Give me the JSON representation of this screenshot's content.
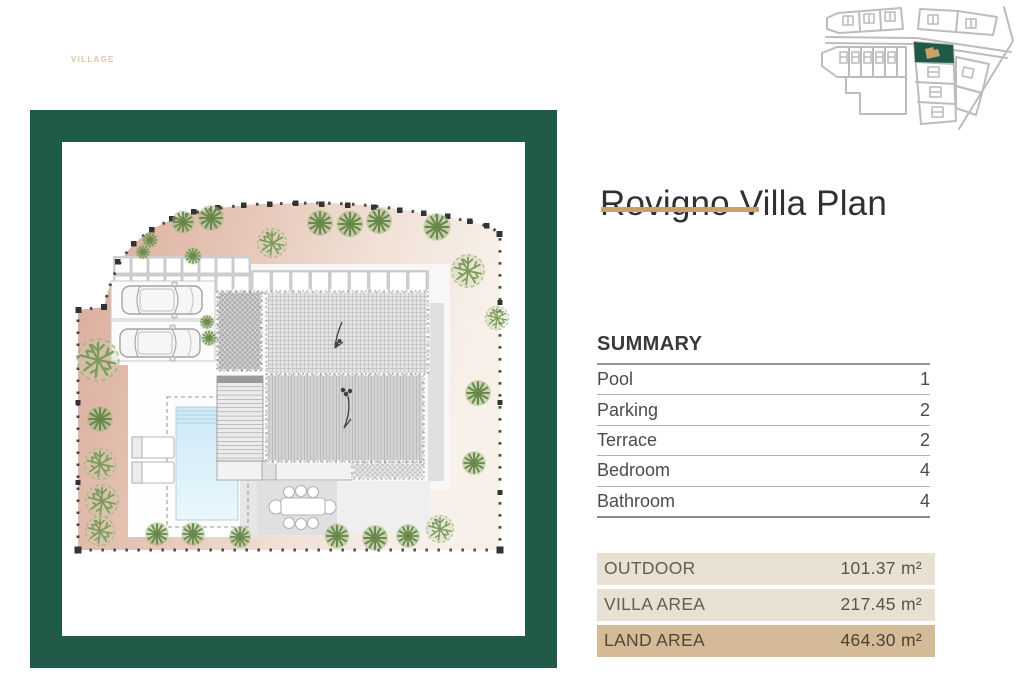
{
  "brand": {
    "watermark": "VILLAGE"
  },
  "header": {
    "title": "Rovigno Villa Plan"
  },
  "summary": {
    "heading": "SUMMARY",
    "rows": [
      {
        "label": "Pool",
        "value": "1"
      },
      {
        "label": "Parking",
        "value": "2"
      },
      {
        "label": "Terrace",
        "value": "2"
      },
      {
        "label": "Bedroom",
        "value": "4"
      },
      {
        "label": "Bathroom",
        "value": "4"
      }
    ]
  },
  "areas": {
    "rows": [
      {
        "label": "OUTDOOR",
        "value": "101.37 m²"
      },
      {
        "label": "VILLA AREA",
        "value": "217.45 m²"
      },
      {
        "label": "LAND AREA",
        "value": "464.30 m²"
      }
    ]
  },
  "plan": {
    "icons": [
      "villa-roof",
      "pool",
      "parking-cars",
      "sun-loungers",
      "dining-set",
      "tree",
      "fence-posts",
      "paver-path"
    ],
    "colors": {
      "frame_green": "#215a49",
      "accent_tan": "#c9a268",
      "area_row_bg": "#e8e1d3",
      "land_row_bg": "#d4ba97",
      "ground_pink": "#dcb3a3",
      "tree_green": "#6e9150",
      "pool_blue": "#cfeaf7",
      "minimap_highlight_green": "#1f5a49",
      "minimap_house_tan": "#c9a066"
    }
  }
}
